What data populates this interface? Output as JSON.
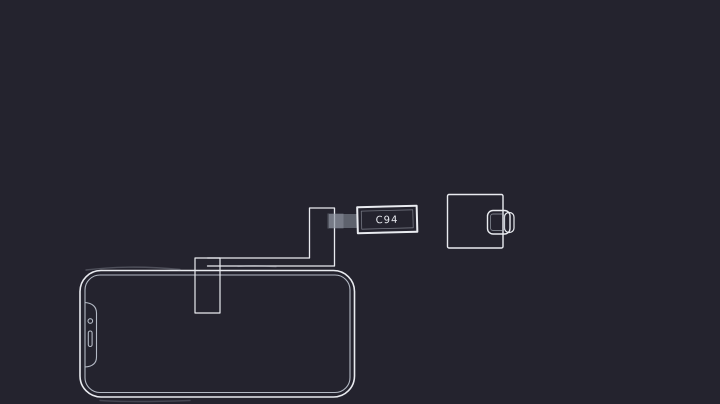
{
  "canvas": {
    "width": 720,
    "height": 404
  },
  "diagram": {
    "labels": {
      "connector": "C94"
    },
    "colors": {
      "background": "#24232e",
      "line_primary": "#e9ebf0",
      "line_secondary": "#b4bac5",
      "ribbon_contacts": "#99a0ac",
      "label_text": "#e9ebf0"
    },
    "parts": {
      "phone": "phone-outline",
      "plate": "connector-plate",
      "cable": "flex-cable-ribbon",
      "connector": "c94-connector",
      "adapter": "usb-c-adapter"
    }
  }
}
